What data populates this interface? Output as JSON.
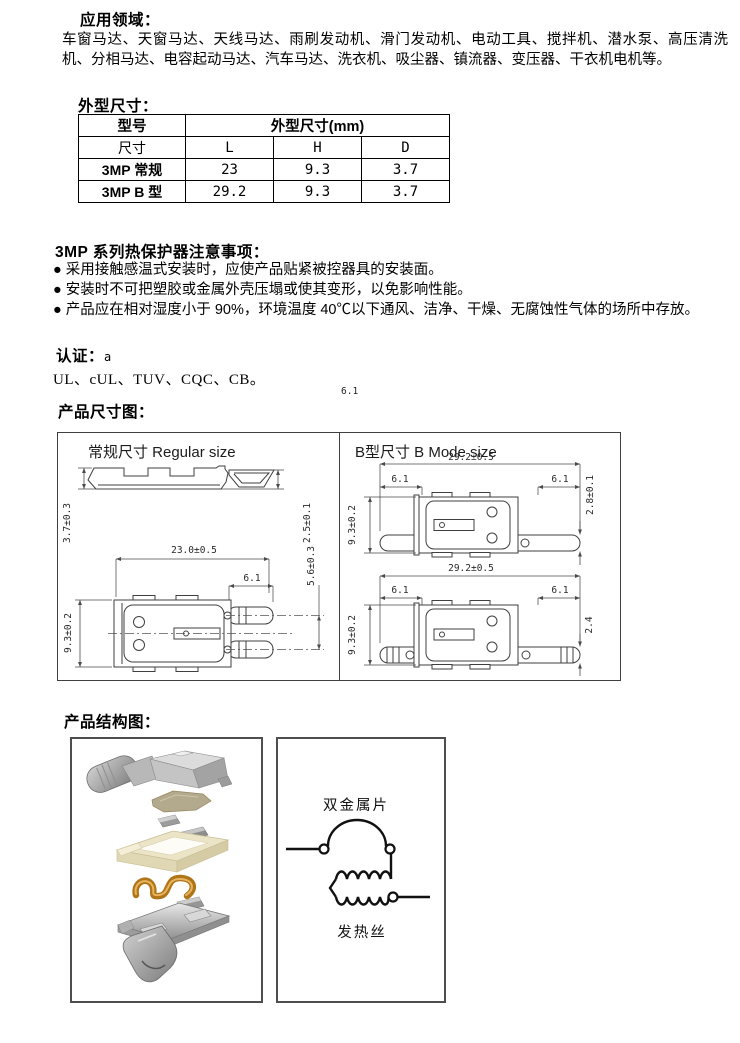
{
  "applications": {
    "heading": "应用领域：",
    "body": "车窗马达、天窗马达、天线马达、雨刷发动机、滑门发动机、电动工具、搅拌机、潜水泵、高压清洗机、分相马达、电容起动马达、汽车马达、洗衣机、吸尘器、镇流器、变压器、干衣机电机等。"
  },
  "outline_dimensions": {
    "heading": "外型尺寸：",
    "table": {
      "col1_header": "型号",
      "span_header": "外型尺寸(mm)",
      "sub_headers": [
        "尺寸",
        "L",
        "H",
        "D"
      ],
      "rows": [
        {
          "model": "3MP 常规",
          "L": "23",
          "H": "9.3",
          "D": "3.7"
        },
        {
          "model": "3MP B 型",
          "L": "29.2",
          "H": "9.3",
          "D": "3.7"
        }
      ]
    }
  },
  "notes": {
    "heading": "3MP 系列热保护器注意事项：",
    "items": [
      "● 采用接触感温式安装时，应使产品贴紧被控器具的安装面。",
      "● 安装时不可把塑胶或金属外壳压塌或使其变形，以免影响性能。",
      "● 产品应在相对湿度小于 90%，环境温度 40℃以下通风、洁净、干燥、无腐蚀性气体的场所中存放。"
    ]
  },
  "certification": {
    "heading": "认证：",
    "suffix": "a",
    "body": "UL、cUL、TUV、CQC、CB。",
    "stray_text": "6.1"
  },
  "dimension_figure": {
    "heading": "产品尺寸图：",
    "regular": {
      "title": "常规尺寸 Regular size",
      "side_height": "3.7±0.3",
      "hook_height": "2.5±0.1",
      "length": "23.0±0.5",
      "terminal_length": "6.1",
      "terminal_pitch": "5.6±0.3",
      "body_width": "9.3±0.2"
    },
    "b_mode": {
      "title": "B型尺寸 B Mode size",
      "top_view": {
        "length": "29.2±0.5",
        "left_terminal": "6.1",
        "right_terminal": "6.1",
        "plate_thickness": "2.8±0.1",
        "body_width": "9.3±0.2"
      },
      "bottom_view": {
        "length": "29.2±0.5",
        "left_terminal": "6.1",
        "right_terminal": "6.1",
        "plate_thickness": "2.4",
        "body_width": "9.3±0.2"
      }
    }
  },
  "structure_figure": {
    "heading": "产品结构图：",
    "circuit": {
      "bimetal_label": "双金属片",
      "heater_label": "发热丝"
    }
  }
}
